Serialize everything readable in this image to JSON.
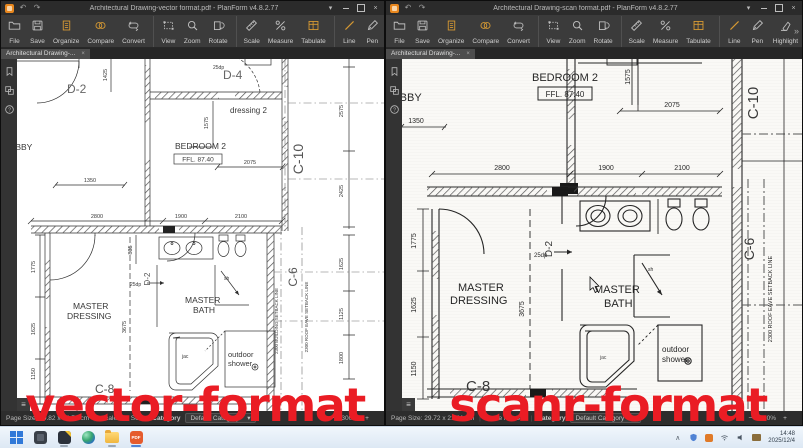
{
  "icons": {
    "undo": "↶",
    "redo": "↷",
    "caret_down": "▾",
    "close": "×",
    "minus": "−",
    "plus": "+",
    "chevrons": "»",
    "menu": "≡",
    "tray_chevron": "∧",
    "help": "?"
  },
  "windows": {
    "left": {
      "title": "Architectural Drawing-vector format.pdf - PlanForm v4.8.2.77",
      "tab": "Architectural Drawing-...",
      "status": {
        "page_size": "Page Size: 50.82 x 66.78 cm",
        "scale": "Scale Not Set",
        "category_label": "Category",
        "category_value": "Default Category",
        "zoom_level": "300%"
      }
    },
    "right": {
      "title": "Architectural Drawing-scan format.pdf - PlanForm v4.8.2.77",
      "tab": "Architectural Drawing-...",
      "status": {
        "page_size": "Page Size: 29.72 x 21.01 cm",
        "scale": "Scale Not Set",
        "category_label": "Category",
        "category_value": "Default Category",
        "zoom_level": "800%"
      }
    }
  },
  "toolbar": {
    "items": [
      {
        "label": "File",
        "icon": "file",
        "accent": false,
        "sep": false
      },
      {
        "label": "Save",
        "icon": "save",
        "accent": false,
        "sep": false
      },
      {
        "label": "Organize",
        "icon": "organize",
        "accent": true,
        "sep": false
      },
      {
        "label": "Compare",
        "icon": "compare",
        "accent": true,
        "sep": false
      },
      {
        "label": "Convert",
        "icon": "convert",
        "accent": false,
        "sep": true
      },
      {
        "label": "View",
        "icon": "view",
        "accent": false,
        "sep": false
      },
      {
        "label": "Zoom",
        "icon": "zoom",
        "accent": false,
        "sep": false
      },
      {
        "label": "Rotate",
        "icon": "rotate",
        "accent": false,
        "sep": true
      },
      {
        "label": "Scale",
        "icon": "scale",
        "accent": false,
        "sep": false
      },
      {
        "label": "Measure",
        "icon": "measure",
        "accent": false,
        "sep": false
      },
      {
        "label": "Tabulate",
        "icon": "tabulate",
        "accent": true,
        "sep": true
      },
      {
        "label": "Line",
        "icon": "line",
        "accent": true,
        "sep": false
      },
      {
        "label": "Pen",
        "icon": "pen",
        "accent": false,
        "sep": false
      },
      {
        "label": "Highlight",
        "icon": "highlight",
        "accent": false,
        "sep": false
      },
      {
        "label": "Text",
        "icon": "text",
        "accent": false,
        "sep": false
      },
      {
        "label": "Sequence",
        "icon": "sequence",
        "accent": true,
        "sep": false
      },
      {
        "label": "Markup",
        "icon": "markup",
        "accent": true,
        "sep": false
      }
    ]
  },
  "plan": {
    "lobby": "LOBBY",
    "bedroom2": "BEDROOM 2",
    "ffl": "FFL. 87.40",
    "dressing2": "dressing 2",
    "master": "MASTER",
    "dressing": "DRESSING",
    "bath": "BATH",
    "jac": "jac",
    "sh": "sh",
    "outdoor": "outdoor",
    "shower": "shower",
    "d2": "D-2",
    "d4": "D-4",
    "dp25": "25dp",
    "c8": "C-8",
    "c10": "C-10",
    "c6": "C-6",
    "roof_line": "2300 ROOF EAVE SETBACK LINE",
    "bld_line": "2300 BUILDING SETBACK LINE",
    "n1350": "1350",
    "n1425": "1425",
    "n2800": "2800",
    "n1900": "1900",
    "n2100": "2100",
    "n2075": "2075",
    "n1575": "1575",
    "n2575": "2575",
    "n2425": "2425",
    "n835": "835",
    "n1775": "1775",
    "n1625": "1625",
    "n1150": "1150",
    "n3675": "3675",
    "n1125": "1125",
    "n1800": "1800"
  },
  "overlay": {
    "left": "vector-format",
    "right": "scanr-format",
    "color": "#ea1c24"
  },
  "taskbar": {
    "pdf_label": "PDF",
    "time": "14:48",
    "date": "2025/12/4"
  }
}
